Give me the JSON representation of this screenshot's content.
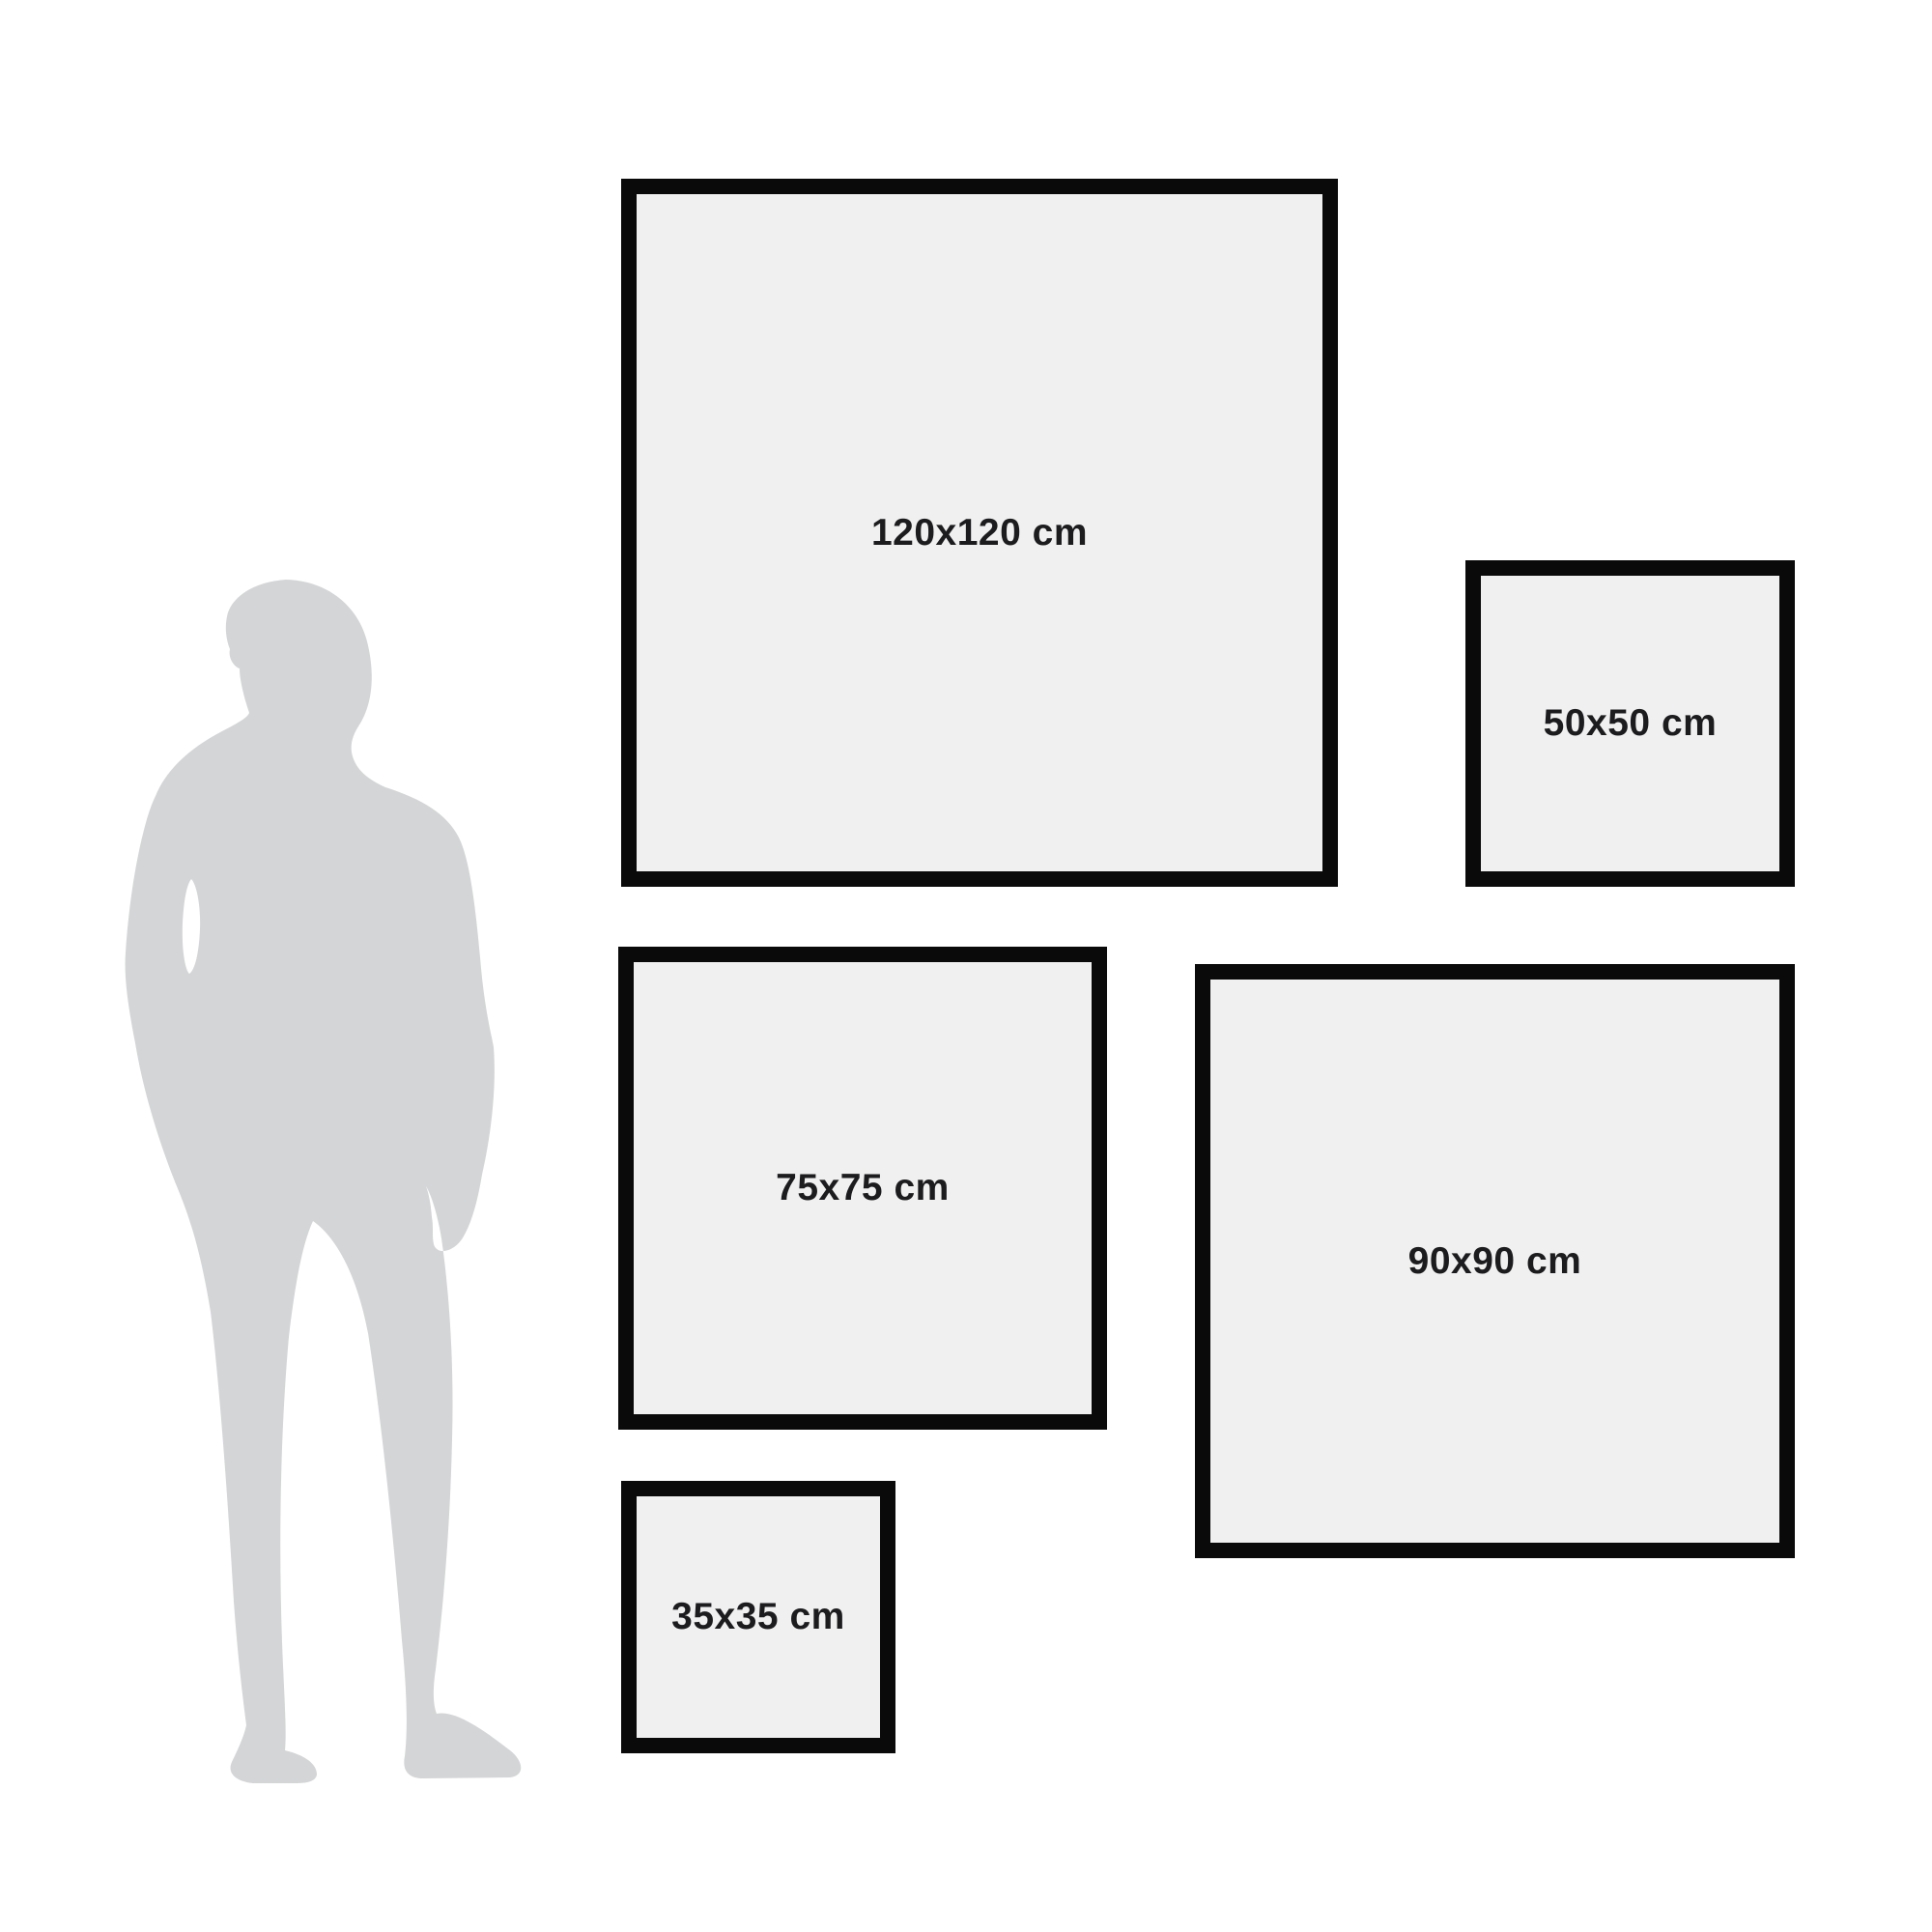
{
  "colors": {
    "background": "#ffffff",
    "frame-border": "#0a0a0a",
    "frame-fill": "#f0f0f1",
    "label-text": "#1c1c1e",
    "silhouette": "#d4d5d7"
  },
  "size_guide": {
    "unit": "cm",
    "frames": [
      {
        "id": "120x120",
        "label": "120x120 cm",
        "width_cm": 120,
        "height_cm": 120
      },
      {
        "id": "50x50",
        "label": "50x50 cm",
        "width_cm": 50,
        "height_cm": 50
      },
      {
        "id": "75x75",
        "label": "75x75 cm",
        "width_cm": 75,
        "height_cm": 75
      },
      {
        "id": "90x90",
        "label": "90x90 cm",
        "width_cm": 90,
        "height_cm": 90
      },
      {
        "id": "35x35",
        "label": "35x35 cm",
        "width_cm": 35,
        "height_cm": 35
      }
    ],
    "reference_figure": {
      "name": "man-silhouette",
      "label": "human figure for scale"
    }
  }
}
